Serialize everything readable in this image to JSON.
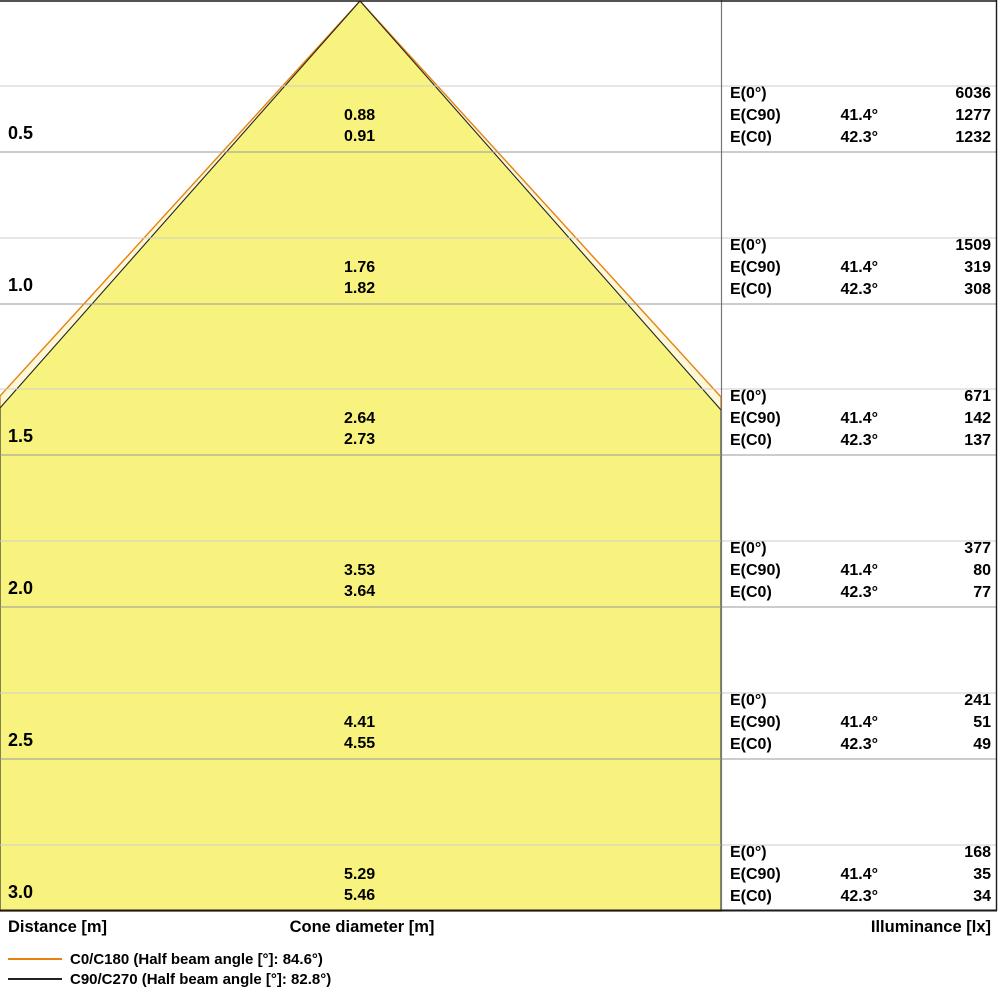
{
  "chart_data": {
    "type": "cone_diagram",
    "axis_labels": {
      "distance": "Distance [m]",
      "cone_diameter": "Cone diameter [m]",
      "illuminance": "Illuminance [lx]"
    },
    "e_labels": {
      "e0": "E(0°)",
      "ec90": "E(C90)",
      "ec0": "E(C0)"
    },
    "legend": [
      {
        "name": "C0/C180",
        "label": "C0/C180 (Half beam angle [°]: 84.6°)",
        "half_beam_angle_deg": 84.6,
        "color": "#E8820F"
      },
      {
        "name": "C90/C270",
        "label": "C90/C270 (Half beam angle [°]: 82.8°)",
        "half_beam_angle_deg": 82.8,
        "color": "#222222"
      }
    ],
    "rows": [
      {
        "distance": "0.5",
        "diameter_c90": "0.88",
        "diameter_c0": "0.91",
        "e_0": "6036",
        "angle_c90": "41.4°",
        "e_c90": "1277",
        "angle_c0": "42.3°",
        "e_c0": "1232"
      },
      {
        "distance": "1.0",
        "diameter_c90": "1.76",
        "diameter_c0": "1.82",
        "e_0": "1509",
        "angle_c90": "41.4°",
        "e_c90": "319",
        "angle_c0": "42.3°",
        "e_c0": "308"
      },
      {
        "distance": "1.5",
        "diameter_c90": "2.64",
        "diameter_c0": "2.73",
        "e_0": "671",
        "angle_c90": "41.4°",
        "e_c90": "142",
        "angle_c0": "42.3°",
        "e_c0": "137"
      },
      {
        "distance": "2.0",
        "diameter_c90": "3.53",
        "diameter_c0": "3.64",
        "e_0": "377",
        "angle_c90": "41.4°",
        "e_c90": "80",
        "angle_c0": "42.3°",
        "e_c0": "77"
      },
      {
        "distance": "2.5",
        "diameter_c90": "4.41",
        "diameter_c0": "4.55",
        "e_0": "241",
        "angle_c90": "41.4°",
        "e_c90": "51",
        "angle_c0": "42.3°",
        "e_c0": "49"
      },
      {
        "distance": "3.0",
        "diameter_c90": "5.29",
        "diameter_c0": "5.46",
        "e_0": "168",
        "angle_c90": "41.4°",
        "e_c90": "35",
        "angle_c0": "42.3°",
        "e_c0": "34"
      }
    ],
    "colors": {
      "cone_fill": "#F7F37E",
      "cone_outer_fill": "#FCF8D8",
      "c0_line": "#E8820F",
      "c90_line": "#222222",
      "gridline": "#9A9A9A",
      "subgridline": "#CCCCCC",
      "border": "#1A1A1A",
      "panel_separator": "#777777"
    }
  }
}
